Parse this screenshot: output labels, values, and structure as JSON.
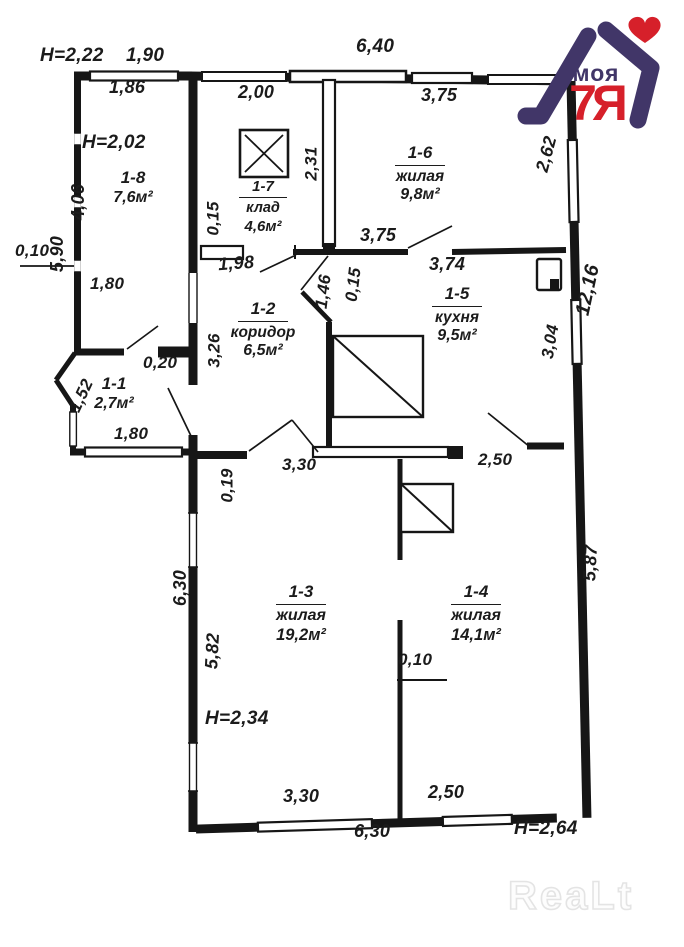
{
  "logo": {
    "brand_top": "моя",
    "brand_main": "7Я",
    "heart": "♥",
    "navy": "#413668",
    "red": "#d6202a"
  },
  "watermark": {
    "text": "ReaLt"
  },
  "rooms": {
    "r18": {
      "id": "1-8",
      "area": "7,6м²"
    },
    "r17": {
      "id": "1-7",
      "name": "клад",
      "area": "4,6м²"
    },
    "r16": {
      "id": "1-6",
      "name": "жилая",
      "area": "9,8м²"
    },
    "r12": {
      "id": "1-2",
      "name": "коридор",
      "area": "6,5м²"
    },
    "r15": {
      "id": "1-5",
      "name": "кухня",
      "area": "9,5м²"
    },
    "r11": {
      "id": "1-1",
      "area": "2,7м²"
    },
    "r13": {
      "id": "1-3",
      "name": "жилая",
      "area": "19,2м²"
    },
    "r14": {
      "id": "1-4",
      "name": "жилая",
      "area": "14,1м²"
    }
  },
  "heights": {
    "h1": "Н=2,22",
    "h2": "Н=2,02",
    "h3": "Н=2,34",
    "h4": "Н=2,64"
  },
  "dims": {
    "d190": "1,90",
    "d186": "1,86",
    "d640": "6,40",
    "d200": "2,00",
    "d375a": "3,75",
    "d375b": "3,75",
    "d406": "4,06",
    "d590": "5,90",
    "d015a": "0,15",
    "d231": "2,31",
    "d262": "2,62",
    "d010a": "0,10",
    "d180a": "1,80",
    "d198": "1,98",
    "d374": "3,74",
    "d146": "1,46",
    "d015b": "0,15",
    "d326": "3,26",
    "d020": "0,20",
    "d152": "1,52",
    "d304": "3,04",
    "d1216": "12,16",
    "d180b": "1,80",
    "d019": "0,19",
    "d330a": "3,30",
    "d250a": "2,50",
    "d630a": "6,30",
    "d582": "5,82",
    "d587": "5,87",
    "d010b": "0,10",
    "d330b": "3,30",
    "d250b": "2,50",
    "d630b": "6,30"
  }
}
